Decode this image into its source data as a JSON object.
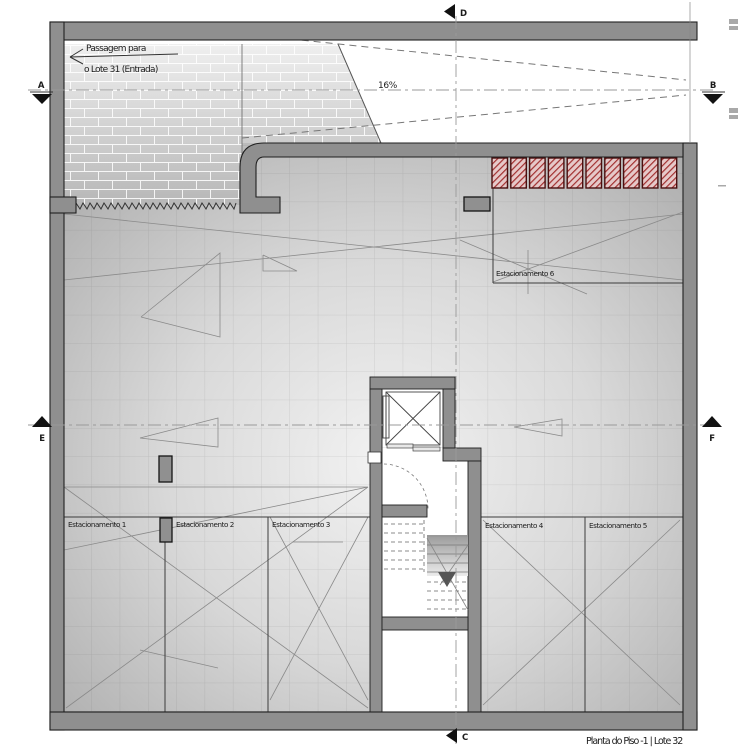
{
  "drawing": {
    "title": "Planta do Piso -1 | Lote 32",
    "annotations": {
      "passage_line1": "Passagem para",
      "passage_line2": "o Lote 31 (Entrada)",
      "ramp_slope": "16%"
    },
    "parking_spaces": [
      "Estacionamento 1",
      "Estacionamento 2",
      "Estacionamento 3",
      "Estacionamento 4",
      "Estacionamento 5",
      "Estacionamento 6"
    ],
    "section_markers": {
      "a": "A",
      "b": "B",
      "c": "C",
      "d": "D",
      "e": "E",
      "f": "F"
    },
    "storage_box_count": 10,
    "colors": {
      "wall": "#8f8f8f",
      "wall_outline": "#1f1f1f",
      "storage_hatch": "#a23030",
      "storage_bg": "#e6c9c9",
      "floor_light": "#f1f1f1",
      "floor_dark": "#a6a6a6"
    }
  }
}
